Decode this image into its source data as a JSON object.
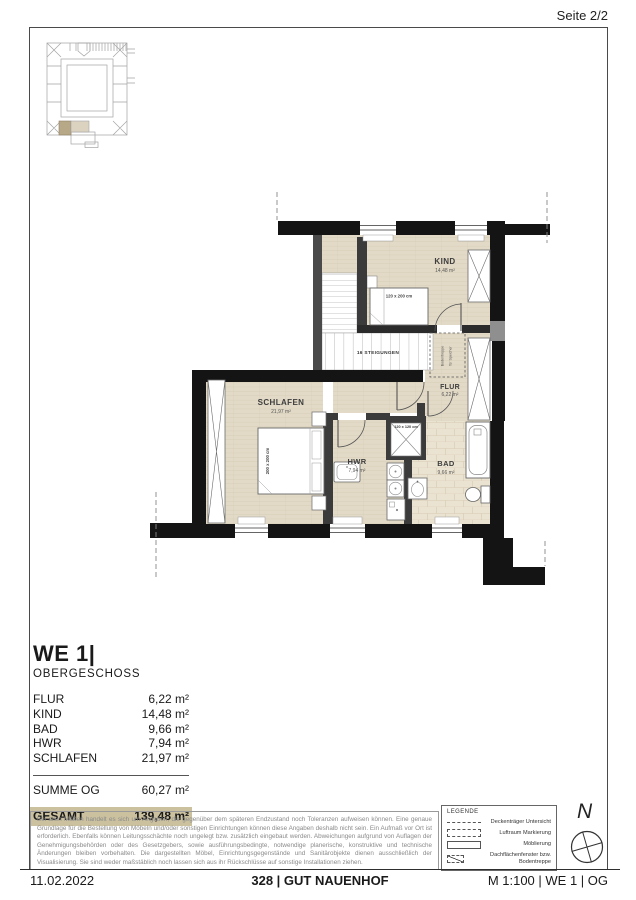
{
  "page": {
    "label": "Seite 2/2"
  },
  "plan": {
    "rooms": {
      "kind": {
        "name": "KIND",
        "area": "14,48 m²"
      },
      "schlafen": {
        "name": "SCHLAFEN",
        "area": "21,97 m²"
      },
      "hwr": {
        "name": "HWR",
        "area": "7,94 m²"
      },
      "bad": {
        "name": "BAD",
        "area": "9,66 m²"
      },
      "flur": {
        "name": "FLUR",
        "area": "6,22 m²"
      }
    },
    "labels": {
      "stairs": "16 STEIGUNGEN",
      "bed_kind": "120 x 200 cm",
      "bed_schlafen": "200 x 200 cm",
      "shower": "120 x 120 cm",
      "attic_line1": "Bodentreppe",
      "attic_line2": "für Speicher"
    }
  },
  "summary": {
    "unit": "WE 1|",
    "floor": "OBERGESCHOSS",
    "rows": [
      {
        "label": "FLUR",
        "value": "6,22 m²"
      },
      {
        "label": "KIND",
        "value": "14,48 m²"
      },
      {
        "label": "BAD",
        "value": "9,66 m²"
      },
      {
        "label": "HWR",
        "value": "7,94 m²"
      },
      {
        "label": "SCHLAFEN",
        "value": "21,97 m²"
      }
    ],
    "subtotal": {
      "label": "SUMME OG",
      "value": "60,27 m²"
    },
    "total": {
      "label": "GESAMT",
      "value": "139,48 m²"
    }
  },
  "disclaimer": "Bei allen Maßen handelt es sich um Angaben, die gegenüber dem späteren Endzustand noch Toleranzen aufweisen können. Eine genaue Grundlage für die Bestellung von Möbeln und/oder sonstigen Einrichtungen können diese Angaben deshalb nicht sein. Ein Aufmaß vor Ort ist erforderlich. Ebenfalls können Leitungsschächte noch ungelegt bzw. zusätzlich eingebaut werden. Abweichungen aufgrund von Auflagen der Genehmigungsbehörden oder des Gesetzgebers, sowie ausführungsbedingte, notwendige planerische, konstruktive und technische Änderungen bleiben vorbehalten. Die dargestellten Möbel, Einrichtungsgegenstände und Sanitärobjekte dienen ausschließlich der Visualisierung. Sie sind weder maßstäblich noch lassen sich aus ihr Rückschlüsse auf sonstige Installationen ziehen.",
  "legend": {
    "title": "LEGENDE",
    "items": [
      {
        "symbol": "dashed-line",
        "label": "Deckenträger Untersicht"
      },
      {
        "symbol": "dashdot-rect",
        "label": "Luftraum Markierung"
      },
      {
        "symbol": "solid-rect",
        "label": "Möblierung"
      },
      {
        "symbol": "dashed-diagonal-rect",
        "label": "Dachflächenfenster bzw. Bodentreppe"
      }
    ]
  },
  "compass": {
    "north": "N"
  },
  "footer": {
    "date": "11.02.2022",
    "project": "328 | GUT NAUENHOF",
    "scale": "M 1:100 | WE 1 | OG"
  },
  "colors": {
    "wall": "#141414",
    "floor_wood": "#e2dac7",
    "floor_tile": "#ebe3d1",
    "total_highlight": "#cbc19f"
  }
}
